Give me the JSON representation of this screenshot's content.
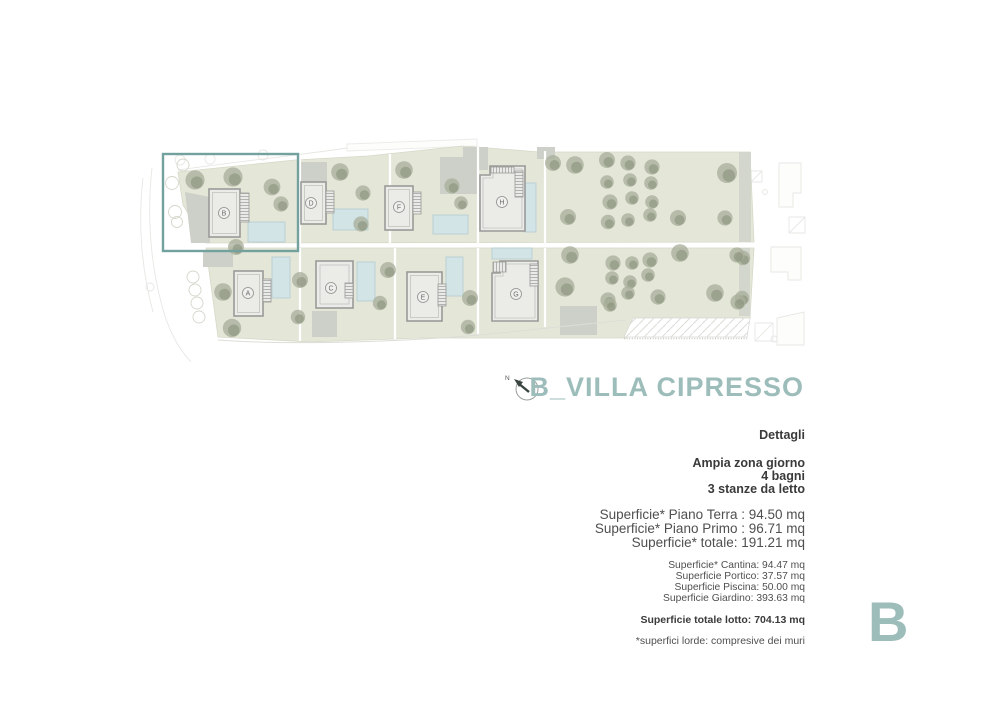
{
  "page": {
    "title": "B_VILLA CIPRESSO",
    "watermark": "B",
    "details": {
      "heading": "Dettagli",
      "features": [
        "Ampia zona giorno",
        "4 bagni",
        "3 stanze da letto"
      ],
      "areas_main": [
        "Superficie* Piano Terra : 94.50 mq",
        "Superficie* Piano Primo : 96.71 mq",
        "Superficie* totale: 191.21 mq"
      ],
      "areas_secondary": [
        "Superficie* Cantina: 94.47 mq",
        "Superficie Portico: 37.57 mq",
        "Superficie Piscina: 50.00 mq",
        "Superficie Giardino: 393.63 mq"
      ],
      "total": "Superficie totale lotto: 704.13 mq",
      "footnote": "*superfici lorde: compresive dei muri"
    }
  },
  "plan": {
    "compass_label": "N",
    "highlighted_villa": "B",
    "villas": [
      {
        "label": "A"
      },
      {
        "label": "B"
      },
      {
        "label": "C"
      },
      {
        "label": "D"
      },
      {
        "label": "E"
      },
      {
        "label": "F"
      },
      {
        "label": "G"
      },
      {
        "label": "H"
      }
    ],
    "colors": {
      "accent": "#9dbdbb",
      "highlight_box": "#73a19d",
      "lot_green": "#e4e7d8",
      "pool_blue": "#d2e4e6",
      "building_gray": "#ebebe8"
    }
  }
}
